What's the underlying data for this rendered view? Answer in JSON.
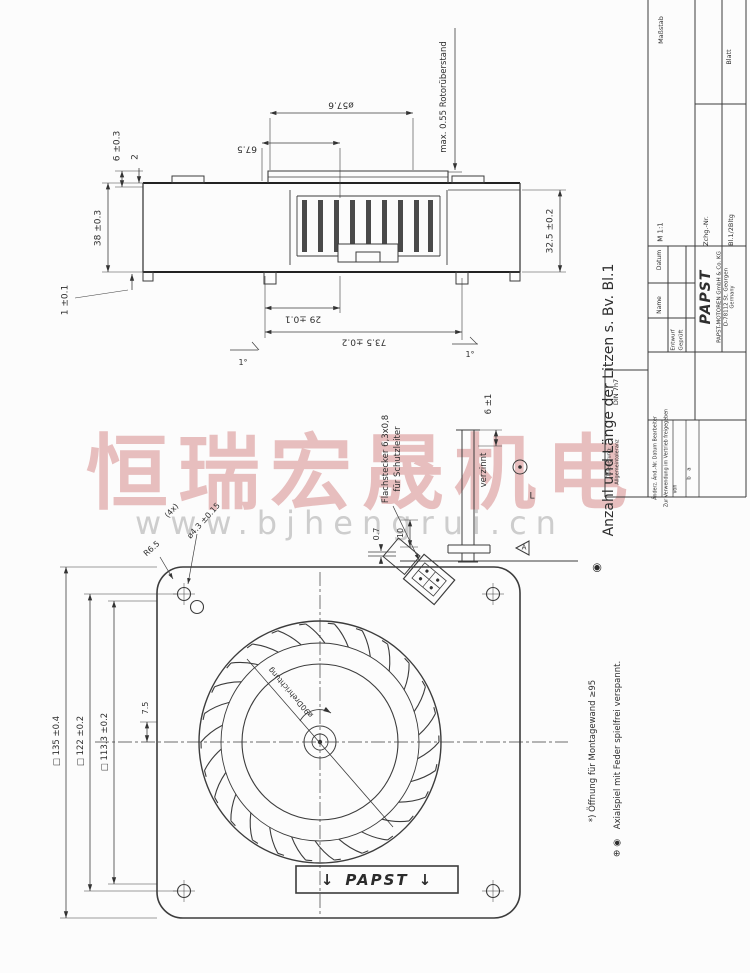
{
  "watermark": {
    "cn": "恒瑞宏晟机电",
    "url": "www.bjhengrui.cn"
  },
  "side_view": {
    "dims": {
      "d6": "6 ±0.3",
      "d2": "2",
      "d38": "38 ±0.3",
      "d1": "1 ±0.1",
      "d675": "67.5",
      "d576": "ø57.6",
      "rotor": "max. 0.55 Rotorüberstand",
      "d325": "32.5 ±0.2",
      "d29": "29 ±0.1",
      "d735": "73.5 ±0.2",
      "angle_left": "1°",
      "angle_right": "1°"
    }
  },
  "connector": {
    "flachstecker_line1": "Flachstecker 6,3x0,8",
    "flachstecker_line2": "für Schutzleiter",
    "verzinnt": "verzinnt",
    "d6_1": "6 ±1",
    "d07": "0.7",
    "d10": "10",
    "label_L": "L",
    "datum_A": "A"
  },
  "notes": {
    "litzen": "Anzahl und Länge der Litzen s. Bv. Bl.1",
    "litzen_symbol": "◉",
    "foot1": "*) Öffnung für Montagewand ≥95",
    "foot2": "Axialspiel mit Feder spielfrei verspannt.",
    "foot2_symbols": "⊕ ◉"
  },
  "front_view": {
    "dims": {
      "sq135": "□ 135 ±0.4",
      "sq122": "□ 122 ±0.2",
      "sq1133": "□ 113.3 ±0.2",
      "d75": "7.5",
      "r65": "R6.5",
      "hole_count": "(4x)",
      "hole": "ø4.3 ±0.15",
      "d90": "ø90",
      "drehrichtung": "Drehrichtung"
    },
    "papst_label": {
      "arrow_left": "↓",
      "text": "PAPST",
      "arrow_right": "↓"
    }
  },
  "title_block": {
    "masstab_label": "Maßstab",
    "masstab_value": "M 1:1",
    "blatt_label": "Blatt",
    "blatt_value": "Bl.1/2Bltg",
    "zchg_label": "Zchg.-Nr.",
    "datum": "Datum",
    "name": "Name",
    "entwurf": "Entwurf",
    "geprueft": "Geprüft",
    "logo": "PAPST",
    "company1": "PAPST-MOTOREN GmbH & Co. KG",
    "company2": "D-78112 St. Georgen",
    "company3": "Germany",
    "tolerierung": "Tolerierung:",
    "allgemein": "Allgemeintoleranz",
    "din": "DIN 7h7",
    "rev1": "Änderz. Änd.-Nr. Datum Bearbeiter",
    "rev2": "Zur Verwendung im Vertrieb freigegeben",
    "rev3": "von",
    "row_a": "a",
    "row_b": "b"
  }
}
